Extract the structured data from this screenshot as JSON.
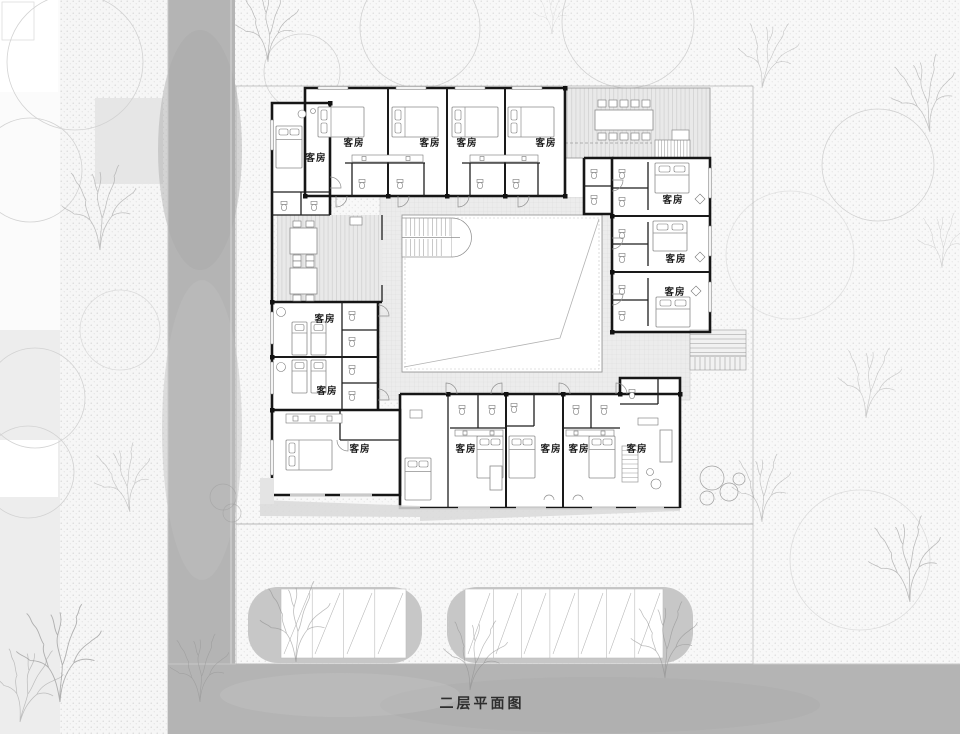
{
  "caption": "二层平面图",
  "room_label_text": "客房",
  "rooms": [
    {
      "label": "客房",
      "wing": "northwest-corner"
    },
    {
      "label": "客房",
      "wing": "north-1"
    },
    {
      "label": "客房",
      "wing": "north-2"
    },
    {
      "label": "客房",
      "wing": "north-3"
    },
    {
      "label": "客房",
      "wing": "north-4"
    },
    {
      "label": "客房",
      "wing": "east-1"
    },
    {
      "label": "客房",
      "wing": "east-2"
    },
    {
      "label": "客房",
      "wing": "east-3"
    },
    {
      "label": "客房",
      "wing": "west-twin-1"
    },
    {
      "label": "客房",
      "wing": "west-twin-2"
    },
    {
      "label": "客房",
      "wing": "southwest"
    },
    {
      "label": "客房",
      "wing": "south-1"
    },
    {
      "label": "客房",
      "wing": "south-2"
    },
    {
      "label": "客房",
      "wing": "south-3"
    },
    {
      "label": "客房",
      "wing": "south-corner"
    }
  ],
  "colors": {
    "background": "#fbfbfb",
    "road": "#b4b4b4",
    "wall": "#161616",
    "tile_floor": "#ececec",
    "hatch_floor": "#e9e9e9",
    "parking_lot": "#c7c7c7",
    "label_text": "#1c1c1c",
    "stipple": "#cbcbcb"
  }
}
